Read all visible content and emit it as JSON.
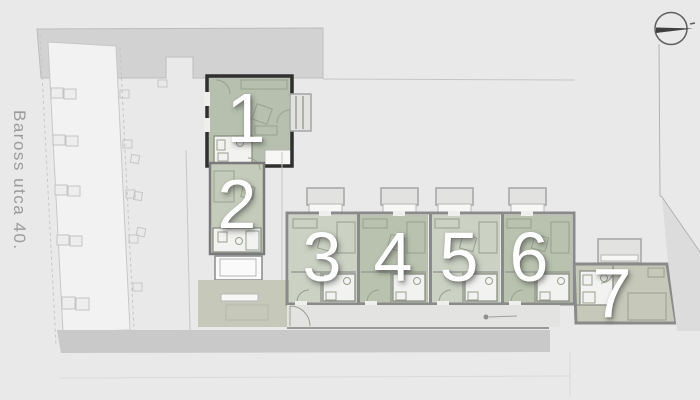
{
  "plan": {
    "street_label": "Baross utca 40.",
    "north_indicator": "north-arrow-icon",
    "units": [
      {
        "id": "unit-1",
        "label": "1"
      },
      {
        "id": "unit-2",
        "label": "2"
      },
      {
        "id": "unit-3",
        "label": "3"
      },
      {
        "id": "unit-4",
        "label": "4"
      },
      {
        "id": "unit-5",
        "label": "5"
      },
      {
        "id": "unit-6",
        "label": "6"
      },
      {
        "id": "unit-7",
        "label": "7"
      }
    ]
  },
  "colors": {
    "background": "#e9e9e9",
    "neighbor_block": "#d2d2d2",
    "street_band": "#c9c9c9",
    "floor_light": "#cbd1c3",
    "floor_dark": "#b8c2ae",
    "floor_unit1": "#b7c0ae",
    "floor_unit2": "#c4cbba",
    "floor_terrace": "#c6c9ba",
    "wall_dark": "#2f2f2f",
    "wall_medium": "#8a8a8a",
    "wall_inner": "#9a9e97",
    "furniture_line": "#98a08f",
    "unit_number_color": "#ffffff",
    "street_label_color": "#9b9b9b"
  }
}
